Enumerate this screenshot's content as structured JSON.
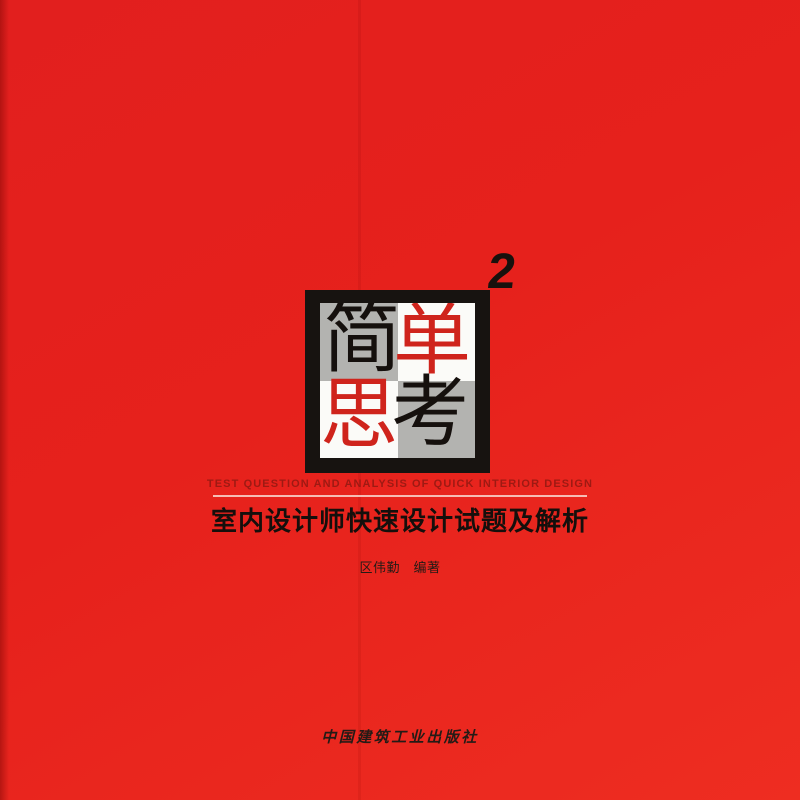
{
  "cover": {
    "type": "book-cover",
    "superscript": "2",
    "logo": {
      "word": "简单思考",
      "characters": [
        {
          "char": "简",
          "color": "#15100d",
          "cell": "top-left"
        },
        {
          "char": "单",
          "color": "#cf241c",
          "cell": "top-right"
        },
        {
          "char": "思",
          "color": "#cf241c",
          "cell": "bottom-left"
        },
        {
          "char": "考",
          "color": "#15100d",
          "cell": "bottom-right"
        }
      ]
    },
    "subtitle_en": "TEST QUESTION AND ANALYSIS OF QUICK INTERIOR DESIGN",
    "title_zh": "室内设计师快速设计试题及解析",
    "author": "区伟勤　编著",
    "publisher": "中国建筑工业出版社",
    "colors": {
      "cover_red": "#e6211c",
      "logo_frame_black": "#171310",
      "logo_gray_cell": "#b3b3b0",
      "logo_white_cell": "#fbfbf8",
      "logo_red_glyph": "#cf241c",
      "subtitle_maroon": "#9e1a13",
      "underline_pink": "#f8d8d0",
      "text_black": "#150f0c"
    }
  }
}
